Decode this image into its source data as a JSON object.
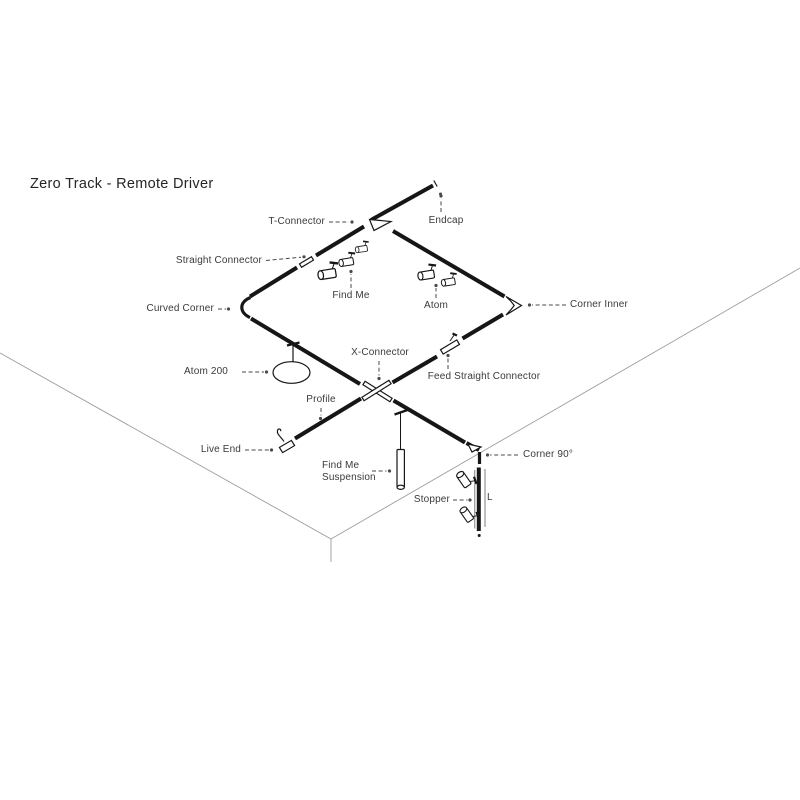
{
  "title": "Zero Track - Remote Driver",
  "diagram": {
    "labels": {
      "t_connector": "T-Connector",
      "endcap": "Endcap",
      "straight_connector": "Straight Connector",
      "curved_corner": "Curved Corner",
      "find_me": "Find Me",
      "atom": "Atom",
      "corner_inner": "Corner Inner",
      "atom_200": "Atom 200",
      "x_connector": "X-Connector",
      "feed_straight_connector": "Feed Straight Connector",
      "profile": "Profile",
      "live_end": "Live End",
      "find_me_suspension": {
        "line1": "Find Me",
        "line2": "Suspension"
      },
      "corner_90": "Corner 90°",
      "stopper": "Stopper",
      "length_marker": "L"
    },
    "colors": {
      "track": "#161616",
      "room_line": "#9c9c9c",
      "label_text": "#3a3a3a",
      "leader_line": "#4a4a4a"
    }
  }
}
